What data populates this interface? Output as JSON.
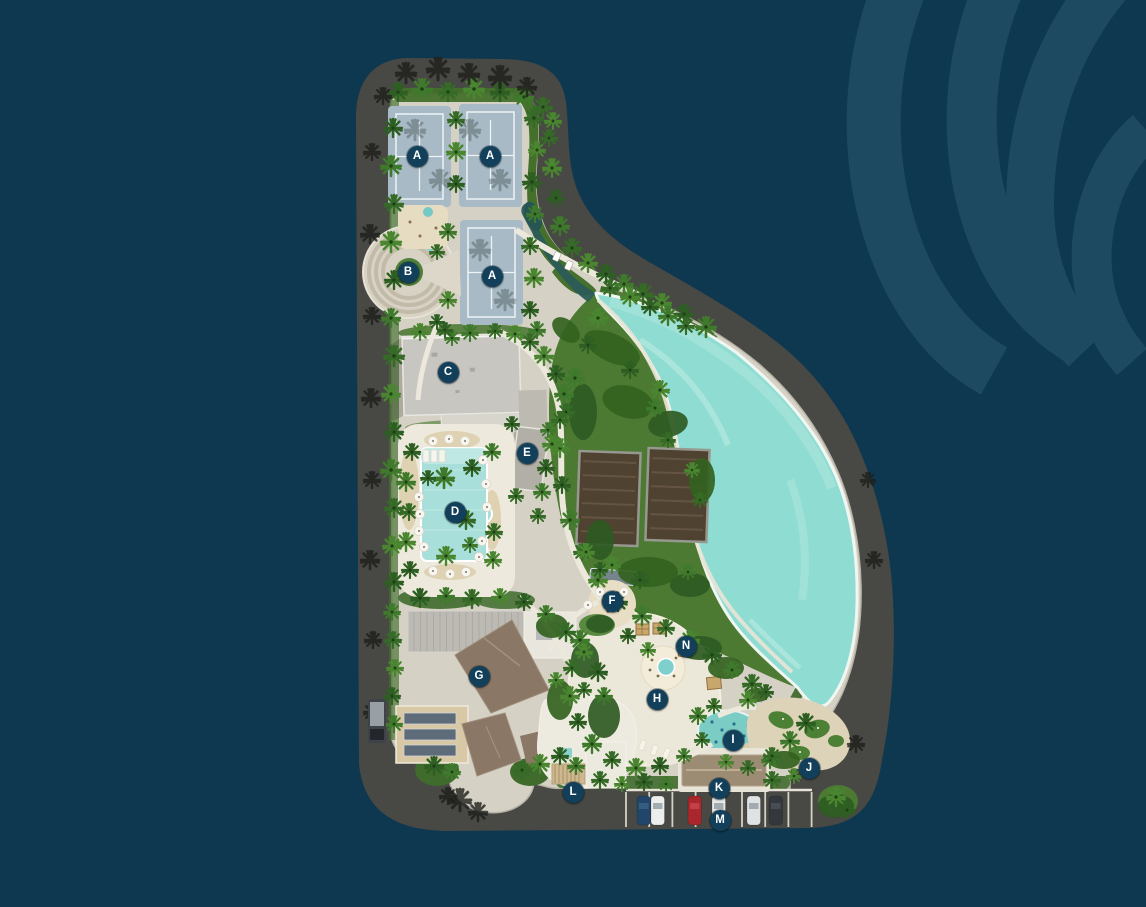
{
  "map": {
    "markers": [
      {
        "label": "A",
        "x": 417,
        "y": 156
      },
      {
        "label": "A",
        "x": 490,
        "y": 156
      },
      {
        "label": "A",
        "x": 492,
        "y": 276
      },
      {
        "label": "B",
        "x": 408,
        "y": 272
      },
      {
        "label": "C",
        "x": 448,
        "y": 372
      },
      {
        "label": "D",
        "x": 455,
        "y": 512
      },
      {
        "label": "E",
        "x": 527,
        "y": 453
      },
      {
        "label": "F",
        "x": 612,
        "y": 601
      },
      {
        "label": "G",
        "x": 479,
        "y": 676
      },
      {
        "label": "H",
        "x": 657,
        "y": 699
      },
      {
        "label": "I",
        "x": 733,
        "y": 740
      },
      {
        "label": "J",
        "x": 809,
        "y": 768
      },
      {
        "label": "K",
        "x": 719,
        "y": 788
      },
      {
        "label": "L",
        "x": 573,
        "y": 792
      },
      {
        "label": "M",
        "x": 720,
        "y": 820
      },
      {
        "label": "N",
        "x": 686,
        "y": 646
      }
    ],
    "colors": {
      "background": "#0d3850",
      "watermark": "#1d4a61",
      "road": "#484844",
      "paving": "#d6d1c5",
      "grass": "#4c7a33",
      "lagoon": "#8fdcd2",
      "pool": "#a9dfda",
      "sand": "#e9e0c8",
      "court": "#a7bac5",
      "court_covered": "#4f4230",
      "roof_brown": "#8a7765",
      "roof_light": "#c8c6c1",
      "marker_bg": "#123f5a",
      "marker_text": "#ffffff"
    }
  }
}
